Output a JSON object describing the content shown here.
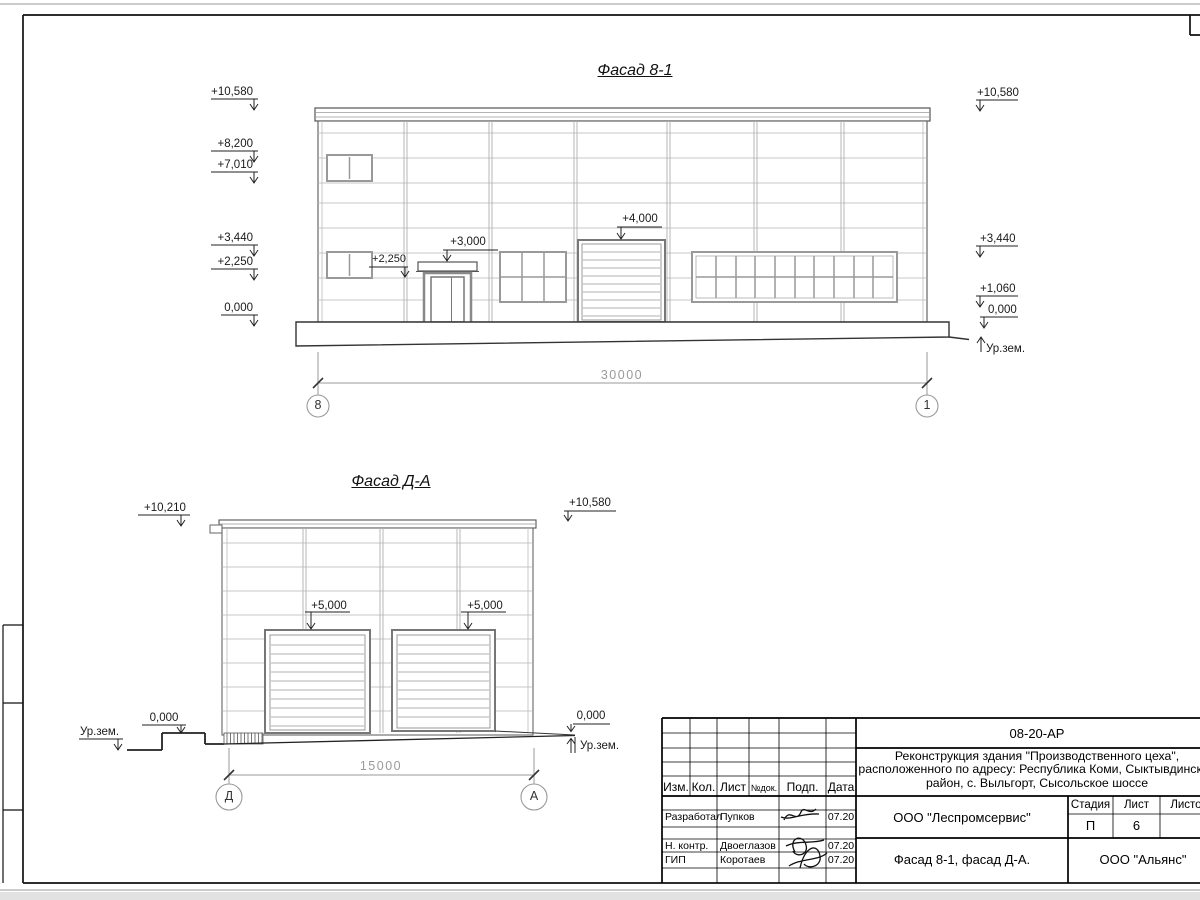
{
  "titles": {
    "f1": "Фасад 8-1",
    "f2": "Фасад Д-А"
  },
  "f1": {
    "marks_left": [
      "+10,580",
      "+8,200",
      "+7,010",
      "+3,440",
      "+2,250",
      "0,000"
    ],
    "marks_right": [
      "+10,580",
      "+3,440",
      "+1,060",
      "0,000"
    ],
    "ground_right": "Ур.зем.",
    "mark_door": "+3,000",
    "mark_gate": "+4,000",
    "mark_window": "+2,250",
    "dim": "30000",
    "axes": [
      "8",
      "1"
    ]
  },
  "f2": {
    "mark_top_left": "+10,210",
    "mark_top_right": "+10,580",
    "mark_gate_left": "+5,000",
    "mark_gate_right": "+5,000",
    "zero_left": "0,000",
    "zero_right": "0,000",
    "ground_left": "Ур.зем.",
    "ground_right": "Ур.зем.",
    "dim": "15000",
    "axes": [
      "Д",
      "А"
    ]
  },
  "tb": {
    "doc": "08-20-АР",
    "proj1": "Реконструкция здания \"Производственного цеха\",",
    "proj2": "расположенного по адресу: Республика Коми, Сыктывдинский",
    "proj3": "район, с. Выльгорт, Сысольское шоссе",
    "cols": [
      "Изм.",
      "Кол.",
      "Лист",
      "№док.",
      "Подп.",
      "Дата"
    ],
    "r1": {
      "role": "Разработал",
      "name": "Пупков",
      "date": "07.20"
    },
    "r2": {
      "role": "Н. контр.",
      "name": "Двоеглазов",
      "date": "07.20"
    },
    "r3": {
      "role": "ГИП",
      "name": "Коротаев",
      "date": "07.20"
    },
    "org": "ООО \"Леспромсервис\"",
    "sheet_title": "Фасад 8-1, фасад Д-А.",
    "customer": "ООО \"Альянс\"",
    "stage_l": "Стадия",
    "list_l": "Лист",
    "listov_l": "Листов",
    "stage": "П",
    "sheet": "6"
  }
}
